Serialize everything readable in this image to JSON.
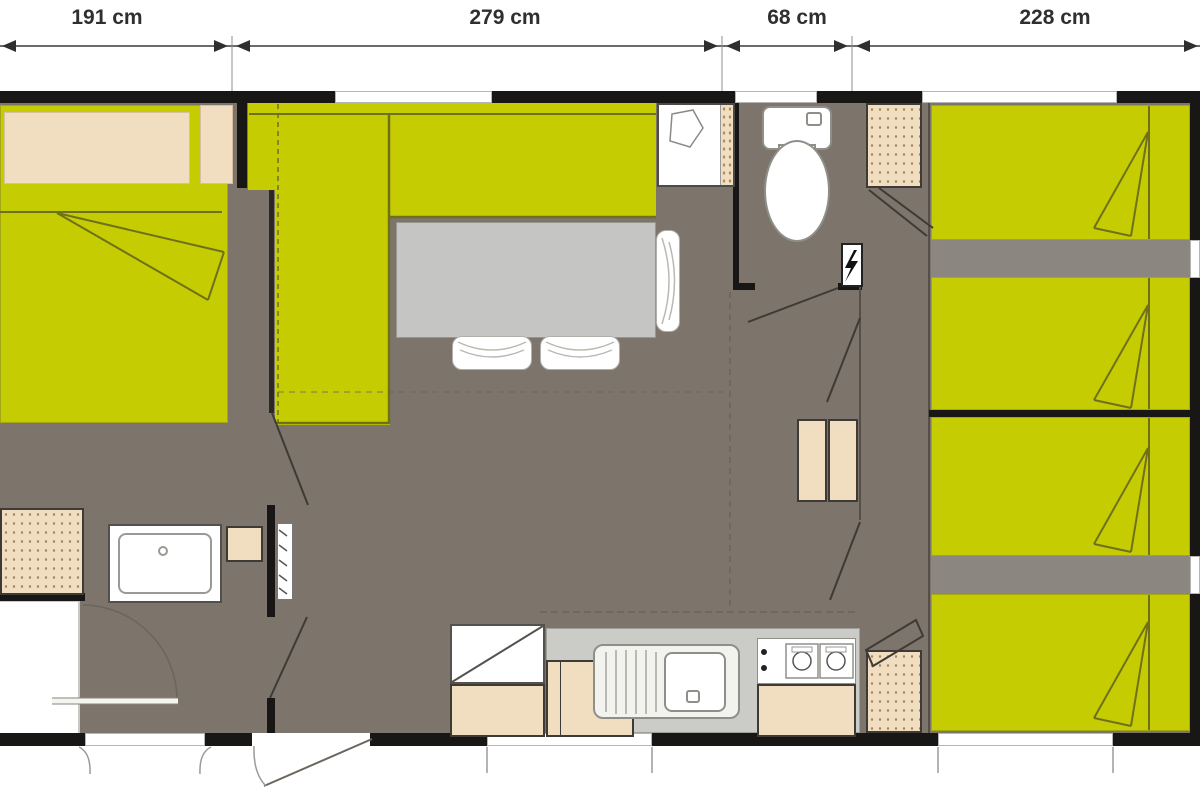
{
  "dimensions": {
    "labels": [
      {
        "text": "191 cm"
      },
      {
        "text": "279 cm"
      },
      {
        "text": "68 cm"
      },
      {
        "text": "228 cm"
      }
    ]
  },
  "symbols": {
    "electric_panel": "lightning-bolt"
  },
  "palette": {
    "bed_yellow": "#c6cc02",
    "floor_gray": "#7d746b",
    "floor_light": "#8b867f",
    "wall_black": "#181715",
    "furniture_beige": "#f1ddbf",
    "wardrobe_dot": "#a88c62",
    "table_gray": "#c5c5c3",
    "counter_gray": "#cbcbc8",
    "line_olive": "#6f701c",
    "dim_text": "#2f2f2f",
    "white": "#ffffff"
  }
}
